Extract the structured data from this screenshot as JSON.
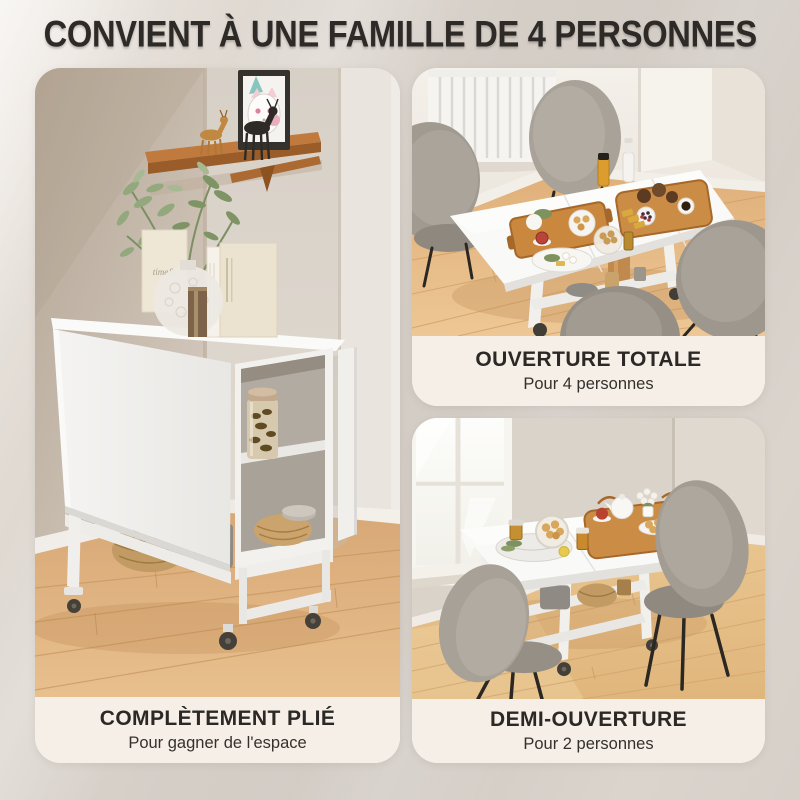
{
  "header": {
    "title": "CONVIENT À UNE FAMILLE DE 4 PERSONNES"
  },
  "panels": [
    {
      "id": "fully-folded",
      "caption": "COMPLÈTEMENT PLIÉ",
      "subcaption": "Pour gagner de l'espace",
      "book_label": "time&"
    },
    {
      "id": "fully-open",
      "caption": "OUVERTURE TOTALE",
      "subcaption": "Pour 4 personnes"
    },
    {
      "id": "half-open",
      "caption": "DEMI-OUVERTURE",
      "subcaption": "Pour 2 personnes"
    }
  ],
  "palette": {
    "page_background": "#d8d2cb",
    "caption_panel_background": "#f6efe7",
    "text_dark": "#2d2a27",
    "floor_wood": "#e2b37c",
    "chair_grey": "#a39d93",
    "table_white": "#f8f8f6",
    "tray_wood": "#c9883e",
    "wall_taupe": "#cfc3b4"
  }
}
